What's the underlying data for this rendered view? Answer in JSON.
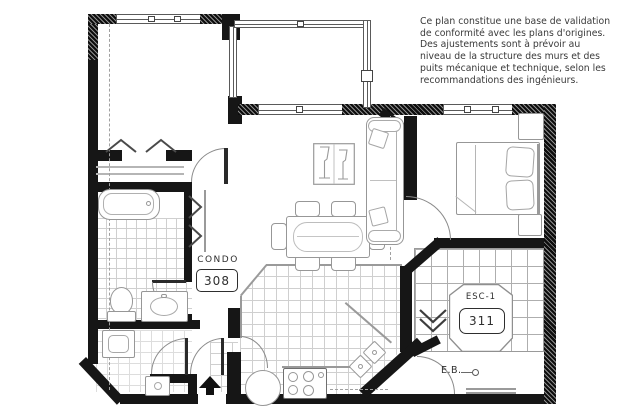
{
  "colors": {
    "wall": "#161616",
    "drawing_line": "#9a9a9a",
    "text": "#2e2e2e",
    "background": "#ffffff"
  },
  "annotation": {
    "lines": [
      "Ce plan constitue une base de validation",
      "de conformité avec les plans d'origines.",
      "Des ajustements sont à prévoir au",
      "niveau de la structure des murs et des",
      "puits mécanique et technique, selon les",
      "recommandations des ingénieurs."
    ]
  },
  "labels": {
    "unit": {
      "title": "CONDO",
      "number": "308"
    },
    "stairs": {
      "title": "ESC-1",
      "number": "311"
    },
    "water_entry": {
      "text": "E.B."
    }
  },
  "icons": {
    "entrance": "arrow-up-icon",
    "stair_direction": "chevron-down-icon",
    "closet_doors": "bifold-chevron-icon"
  }
}
